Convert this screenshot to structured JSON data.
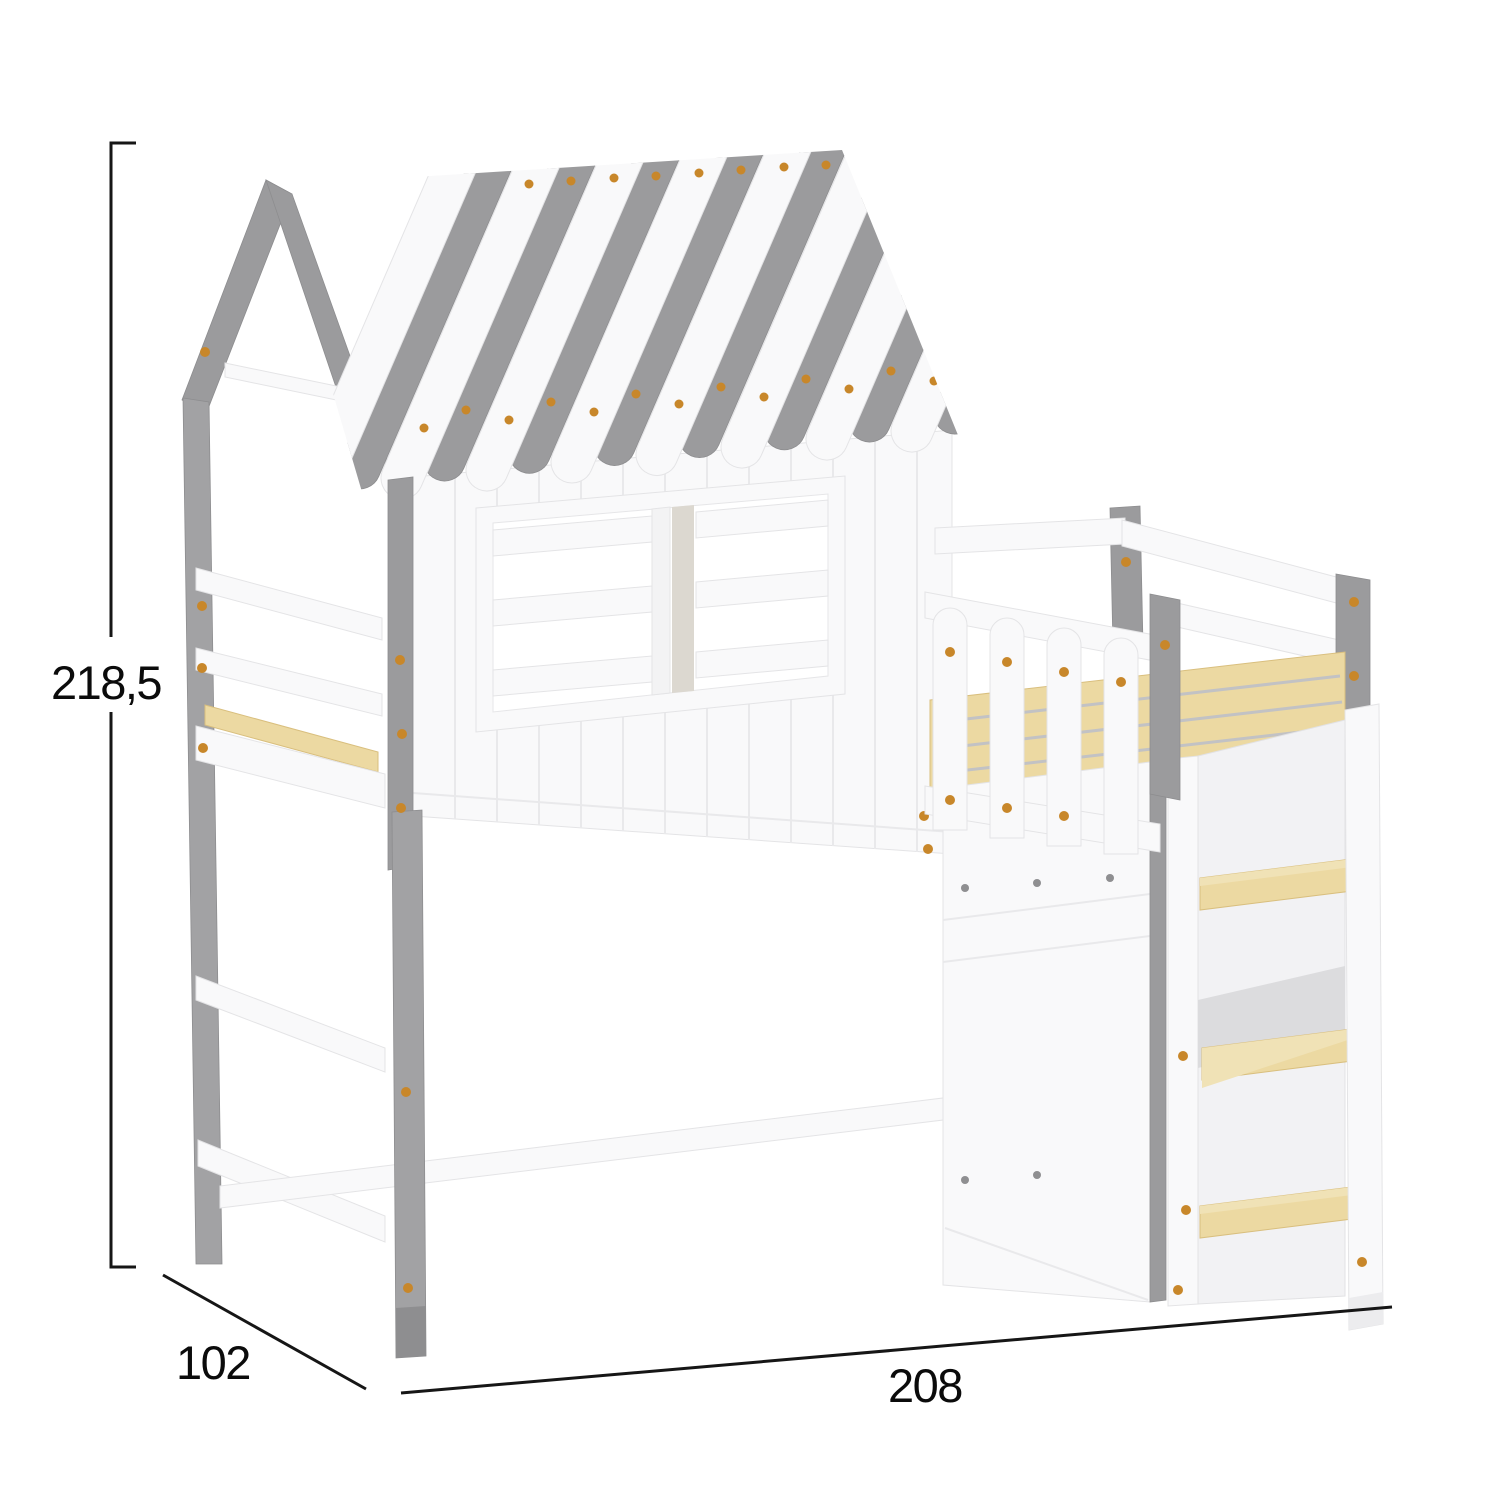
{
  "diagram": {
    "kind": "product-dimension-diagram",
    "subject": "house-shaped kids loft bed with striped roof canopy, window, guard rails, picket fence, storage steps and wooden ladder"
  },
  "dimensions": {
    "height": {
      "label": "218,5"
    },
    "depth": {
      "label": "102"
    },
    "width": {
      "label": "208"
    }
  },
  "colors": {
    "background": "#ffffff",
    "frame_white": "#f9f9fa",
    "frame_gray": "#9b9b9d",
    "wood_slats": "#ecd9a2",
    "screw_orange": "#c8872a",
    "dimension_line": "#161616",
    "label_text": "#0b0b0b"
  }
}
